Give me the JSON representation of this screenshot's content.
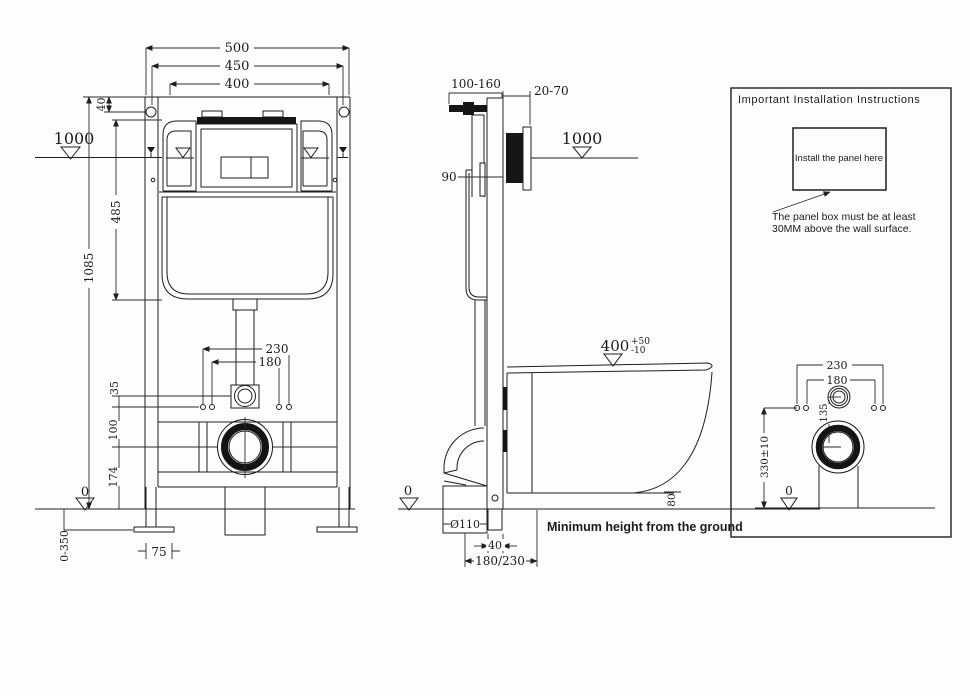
{
  "theme": {
    "background": "#fdfdfd",
    "line_color": "#1e1e1e",
    "text_color": "#1b1b1b"
  },
  "front_view": {
    "dim_500": "500",
    "dim_450": "450",
    "dim_400": "400",
    "dim_40": "40",
    "datum_1000": "1000",
    "dim_485": "485",
    "dim_1085": "1085",
    "dim_230": "230",
    "dim_180": "180",
    "dim_35": "35",
    "dim_100": "100",
    "dim_174": "174",
    "datum_0": "0",
    "dim_0_350": "0-350",
    "dim_75": "75"
  },
  "side_view": {
    "dim_100_160": "100-160",
    "dim_20_70": "20-70",
    "datum_1000": "1000",
    "dim_90": "90",
    "dim_400": "400",
    "tol_plus": "+50",
    "tol_minus": "-10",
    "dim_80": "80",
    "datum_0": "0",
    "dim_dia110": "Ø110",
    "dim_40": "40",
    "dim_180_230": "180/230",
    "note": "Minimum height from the ground"
  },
  "instruction_panel": {
    "title": "Important Installation Instructions",
    "panel_box_label": "Install the panel here",
    "note_line1": "The panel box must be at least",
    "note_line2": "30MM above the wall surface.",
    "dim_230": "230",
    "dim_180": "180",
    "dim_135": "135",
    "dim_330": "330±10",
    "datum_0": "0"
  }
}
